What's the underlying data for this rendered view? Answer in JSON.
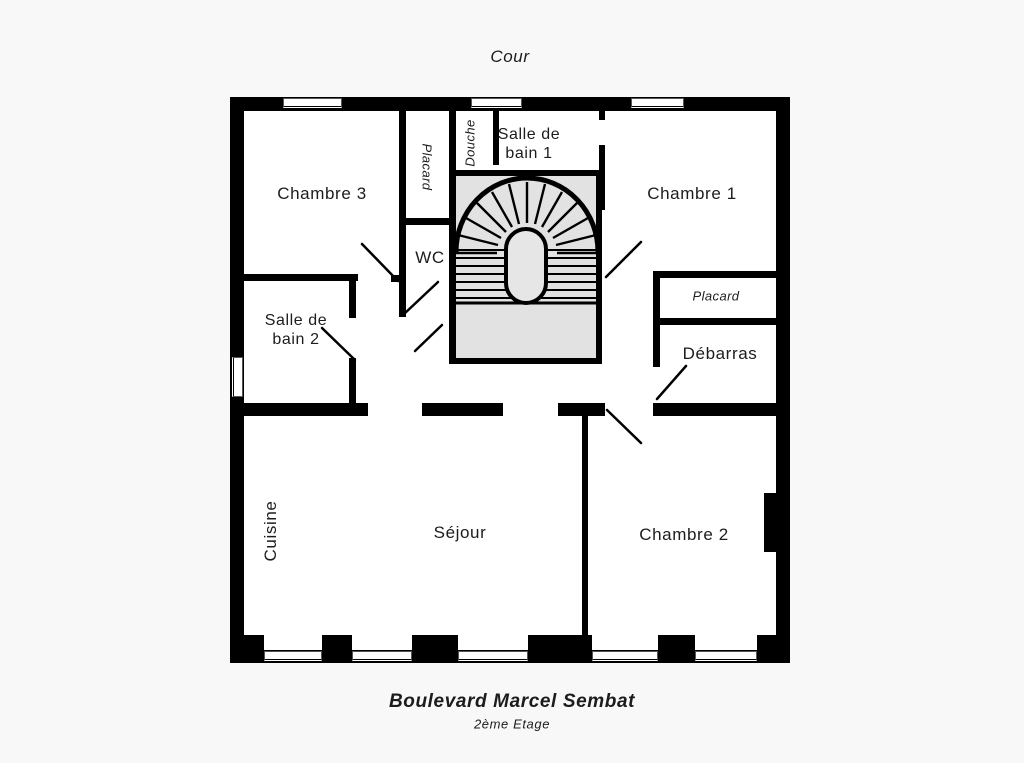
{
  "plan": {
    "top_label": "Cour",
    "bottom_title": "Boulevard Marcel Sembat",
    "bottom_subtitle": "2ème Etage"
  },
  "rooms": {
    "chambre3": "Chambre 3",
    "placard_nord": "Placard",
    "douche": "Douche",
    "sdb1_l1": "Salle de",
    "sdb1_l2": "bain 1",
    "chambre1": "Chambre 1",
    "wc": "WC",
    "sdb2_l1": "Salle de",
    "sdb2_l2": "bain 2",
    "placard_est": "Placard",
    "debarras": "Débarras",
    "cuisine": "Cuisine",
    "sejour": "Séjour",
    "chambre2": "Chambre 2"
  },
  "colors": {
    "wall": "#000000",
    "stair": "#e2e2e2",
    "ink": "#1c1c1c"
  }
}
